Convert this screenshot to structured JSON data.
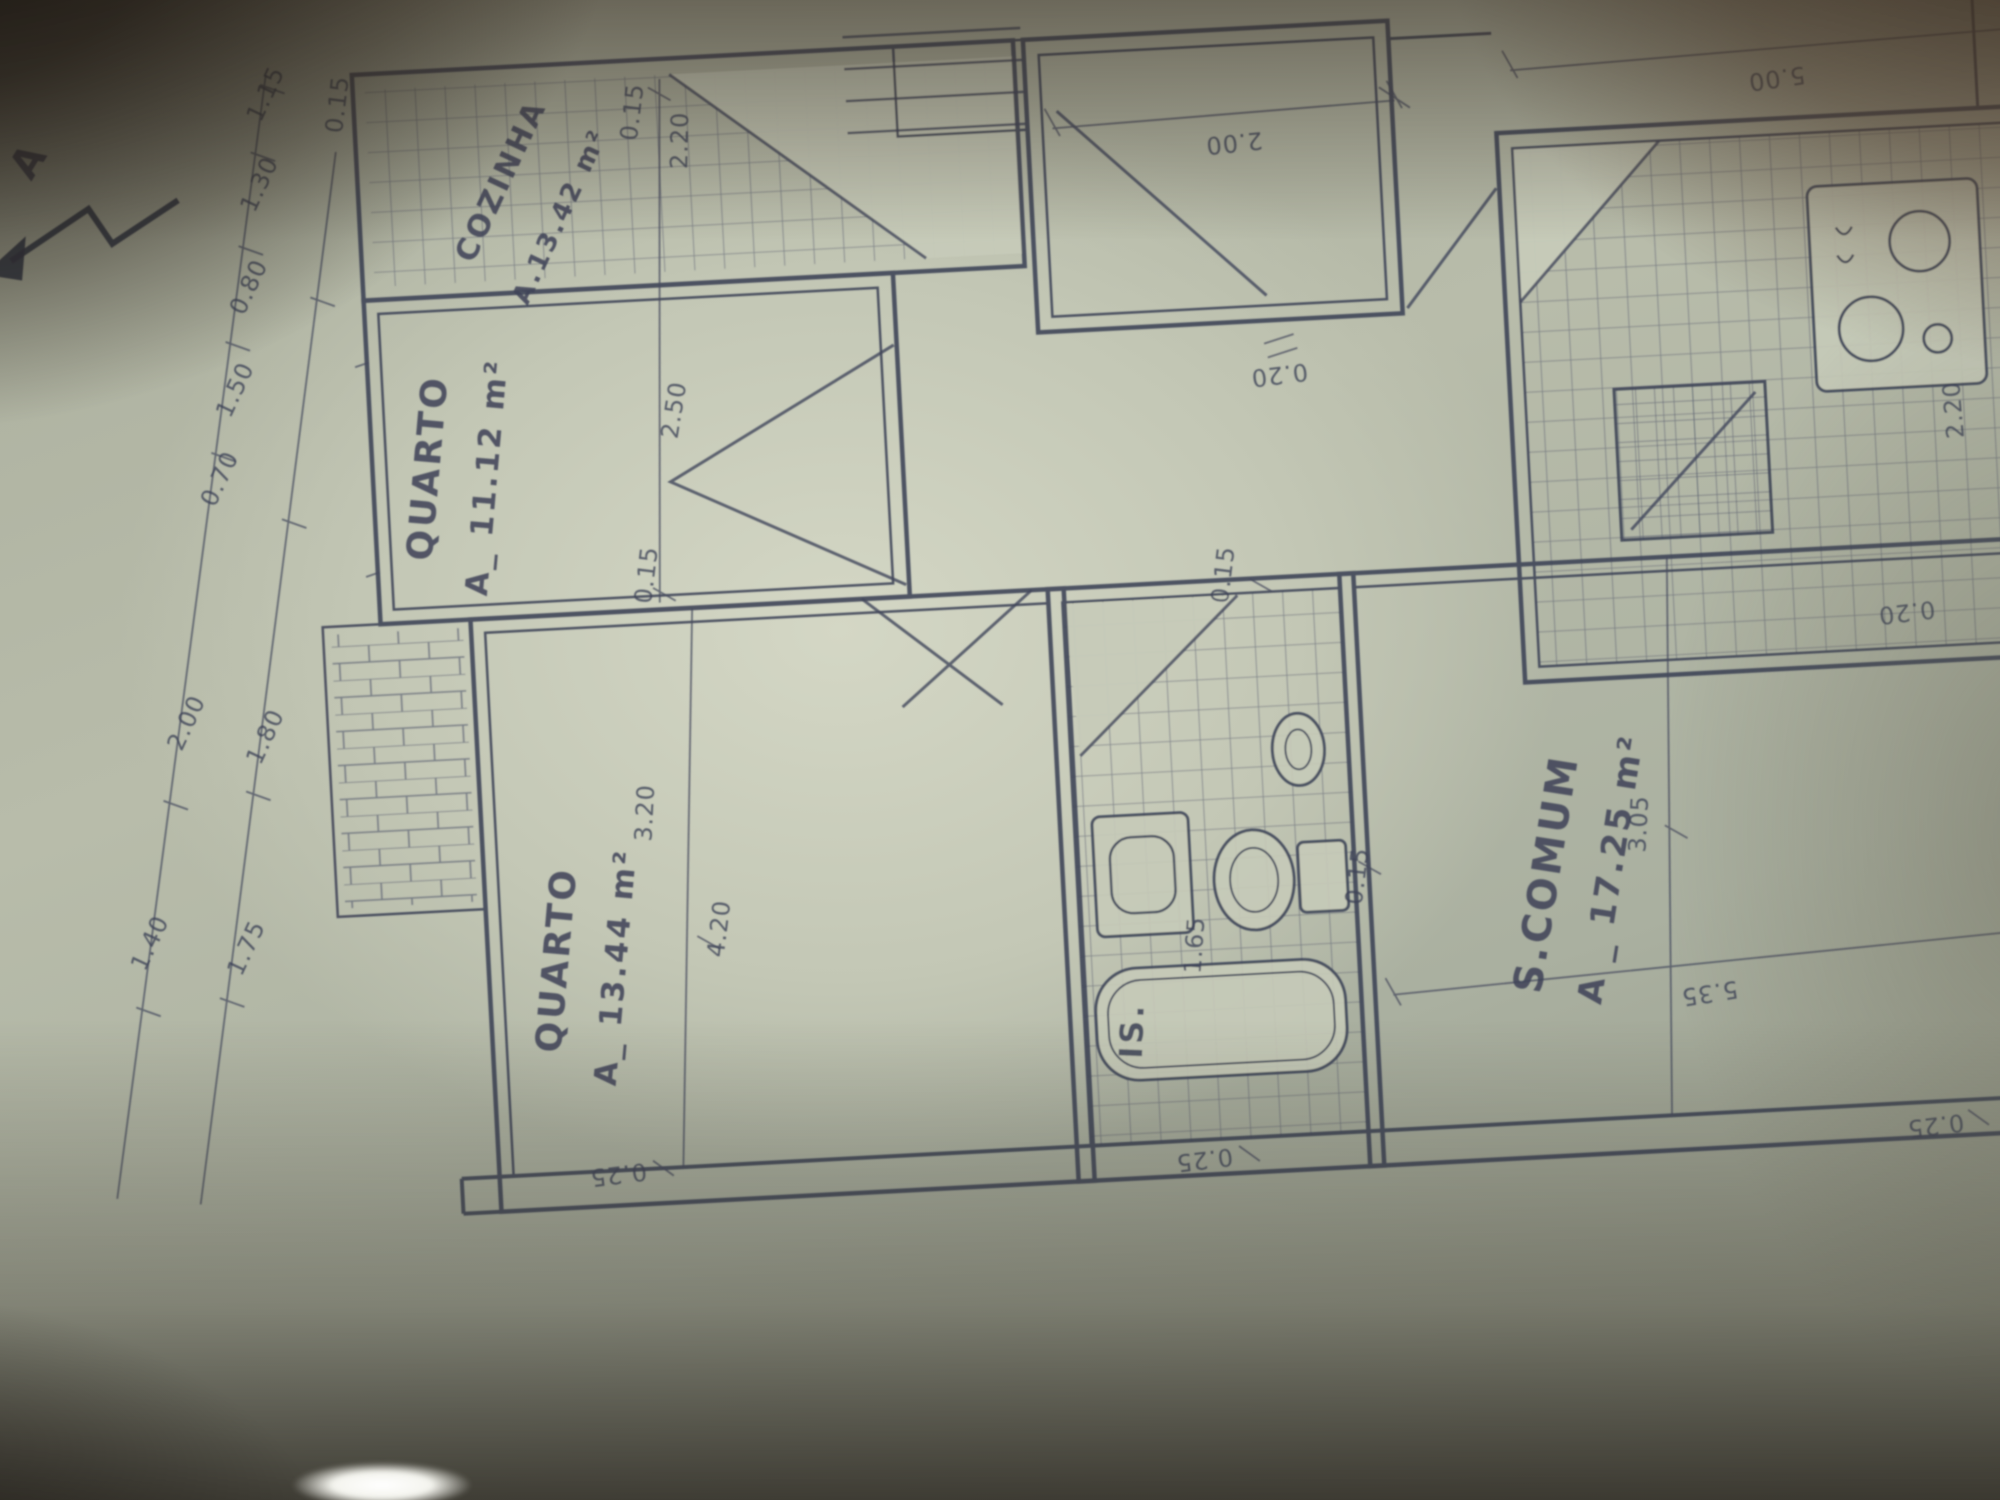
{
  "marker": {
    "label": "A"
  },
  "rooms": {
    "cozinha": {
      "name": "COZINHA",
      "area": "A.13.42 m²"
    },
    "quarto1": {
      "name": "QUARTO",
      "area": "A_ 11.12 m²"
    },
    "quarto2": {
      "name": "QUARTO",
      "area": "A_ 13.44 m²"
    },
    "scomum": {
      "name": "S.COMUM",
      "area": "A _ 17.25 m²"
    },
    "banheiro": {
      "name": "IS."
    }
  },
  "dims": {
    "d015": "0.15",
    "d020": "0.20",
    "d025": "0.25",
    "d070": "0.70",
    "d080": "0.80",
    "d115": "1.15",
    "d130": "1.30",
    "d140": "1.40",
    "d150": "1.50",
    "d165": "1.65",
    "d175": "1.75",
    "d180": "1.80",
    "d200": "2.00",
    "d220": "2.20",
    "d250": "2.50",
    "d305": "3.05",
    "d320": "3.20",
    "d420": "4.20",
    "d500": "5.00",
    "d535": "5.35"
  }
}
